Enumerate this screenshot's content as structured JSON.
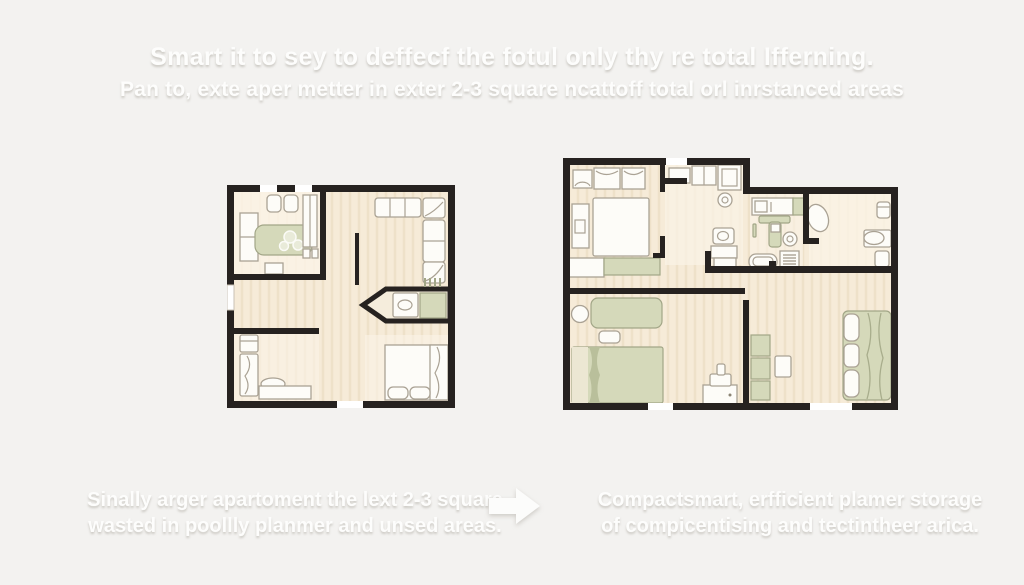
{
  "header": {
    "title": "Smart it to sey to deffecf the fotul only thy re total Ifferning.",
    "subtitle": "Pan to, exte aper metter in exter 2-3 square ncattoff total orl inrstanced areas"
  },
  "plans": {
    "left": {
      "caption_line1": "Sinally arger apartoment the lext 2-3 square",
      "caption_line2": "wasted in poollly planmer and unsed areas."
    },
    "right": {
      "caption_line1": "Compactsmart, erfficient plamer storage",
      "caption_line2": "of compicentising and tectintheer arica."
    },
    "arrow_icon": "arrow-right-icon"
  },
  "colors": {
    "background": "#f3f2f0",
    "wall": "#262220",
    "floor": "#f6ebd8",
    "floor_light": "#fbf4e7",
    "furniture_white": "#fdfcf8",
    "furniture_green": "#d5d9ba",
    "text": "#fdfdfc"
  }
}
